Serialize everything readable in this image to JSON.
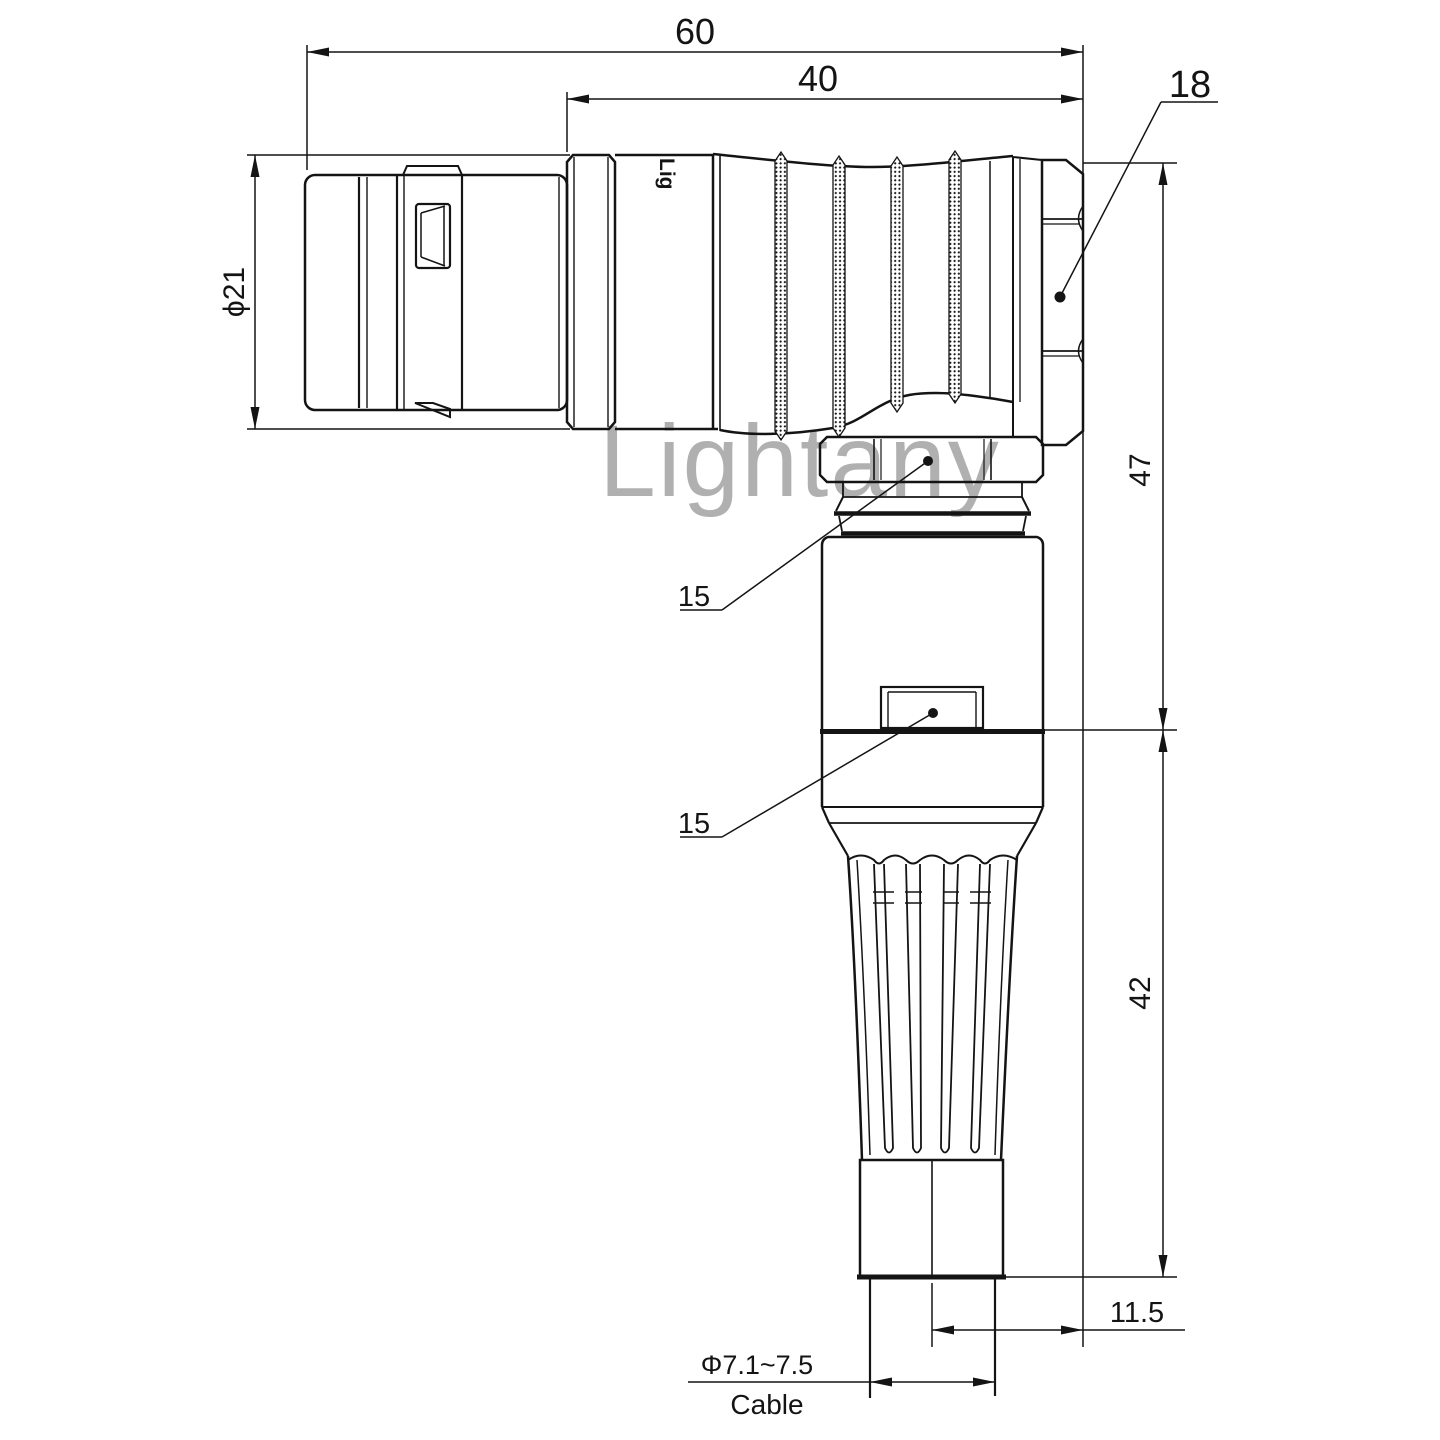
{
  "watermark": {
    "text": "Lightany",
    "color": "#f08080"
  },
  "brand_print": "Lig",
  "dimensions": {
    "overall_length": "60",
    "backshell_length": "40",
    "nut_size": "18",
    "front_diameter": "ϕ21",
    "upper_height": "47",
    "lower_height": "42",
    "leader_upper": "15",
    "leader_lower": "15",
    "cable_offset": "11.5",
    "cable_diameter": "Φ7.1~7.5",
    "cable_label": "Cable"
  },
  "colors": {
    "line": "#141414"
  }
}
